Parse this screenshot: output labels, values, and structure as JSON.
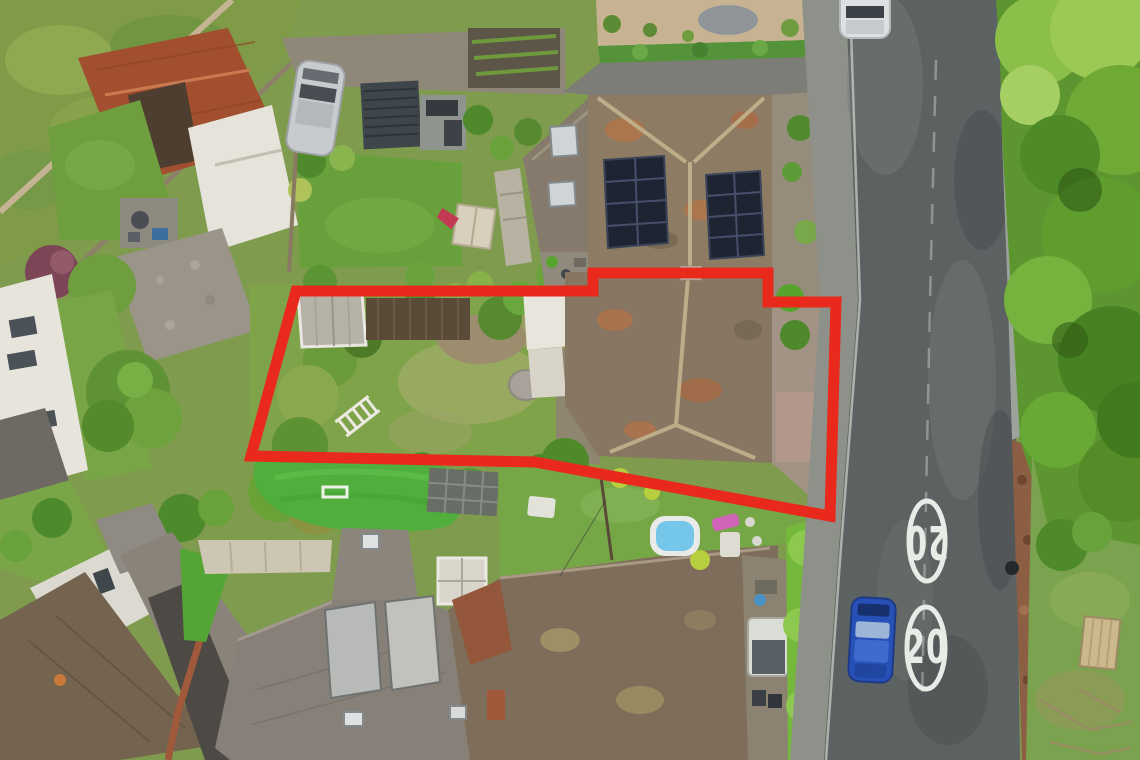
{
  "meta": {
    "title": "Aerial drone photograph of a residential property, its garden and bungalow outlined in red, beside a 20 mph road",
    "type": "aerial-photograph",
    "width": 1140,
    "height": 760
  },
  "boundary": {
    "label": "property-boundary-outline",
    "color": "#e8291c",
    "stroke_width": 11,
    "points": "296,291 593,291 593,273 768,273 768,302 836,302 830,516 535,462 251,456"
  },
  "road": {
    "label": "residential-road",
    "surface_color": "#5c6162",
    "markings": [
      {
        "text": "20",
        "type": "speed-limit-roundel",
        "orientation": "upright",
        "color": "#e9ebe6"
      },
      {
        "text": "20",
        "type": "speed-limit-roundel",
        "orientation": "rotated-180",
        "color": "#e9ebe6"
      }
    ]
  },
  "features": {
    "main_house": {
      "label": "bungalow with solar panels",
      "roof_color": "#8d7b64"
    },
    "solar_arrays": {
      "count": 2,
      "panel_color": "#1e2431"
    },
    "neighbour_house": {
      "label": "adjoining house with two skylights",
      "roof_color": "#857a6c"
    },
    "outbuilding": {
      "label": "garden outbuilding",
      "roof_color": "#b6b2a8"
    },
    "ladder": {
      "label": "ladder lying on lawn",
      "color": "#eceae2"
    },
    "paddling_pool": {
      "label": "paddling pool",
      "color": "#74c7e8"
    },
    "pergola": {
      "label": "slatted pergola",
      "color": "#3f464b"
    },
    "playhouse": {
      "label": "kids playhouse with red slide",
      "slide_color": "#c23b52"
    },
    "parked_car_blue": {
      "label": "blue car parked on road",
      "color": "#2851b8"
    },
    "car_white": {
      "label": "white car on road (top)",
      "color": "#dde0e1"
    },
    "car_silver": {
      "label": "silver car on driveway",
      "color": "#c7cbce"
    },
    "blue_fence": {
      "label": "blue chain-link fence",
      "color": "#4284c8"
    },
    "picnic_table": {
      "label": "wooden picnic table on green",
      "color": "#cbb98c"
    },
    "hedge": {
      "label": "bright garden hedge",
      "color": "#74b83c"
    },
    "artificial_lawn": {
      "label": "artificial turf with mini goal",
      "color": "#4fae3c"
    },
    "trees": {
      "label": "tree canopy along road",
      "color": "#5d9630"
    }
  }
}
